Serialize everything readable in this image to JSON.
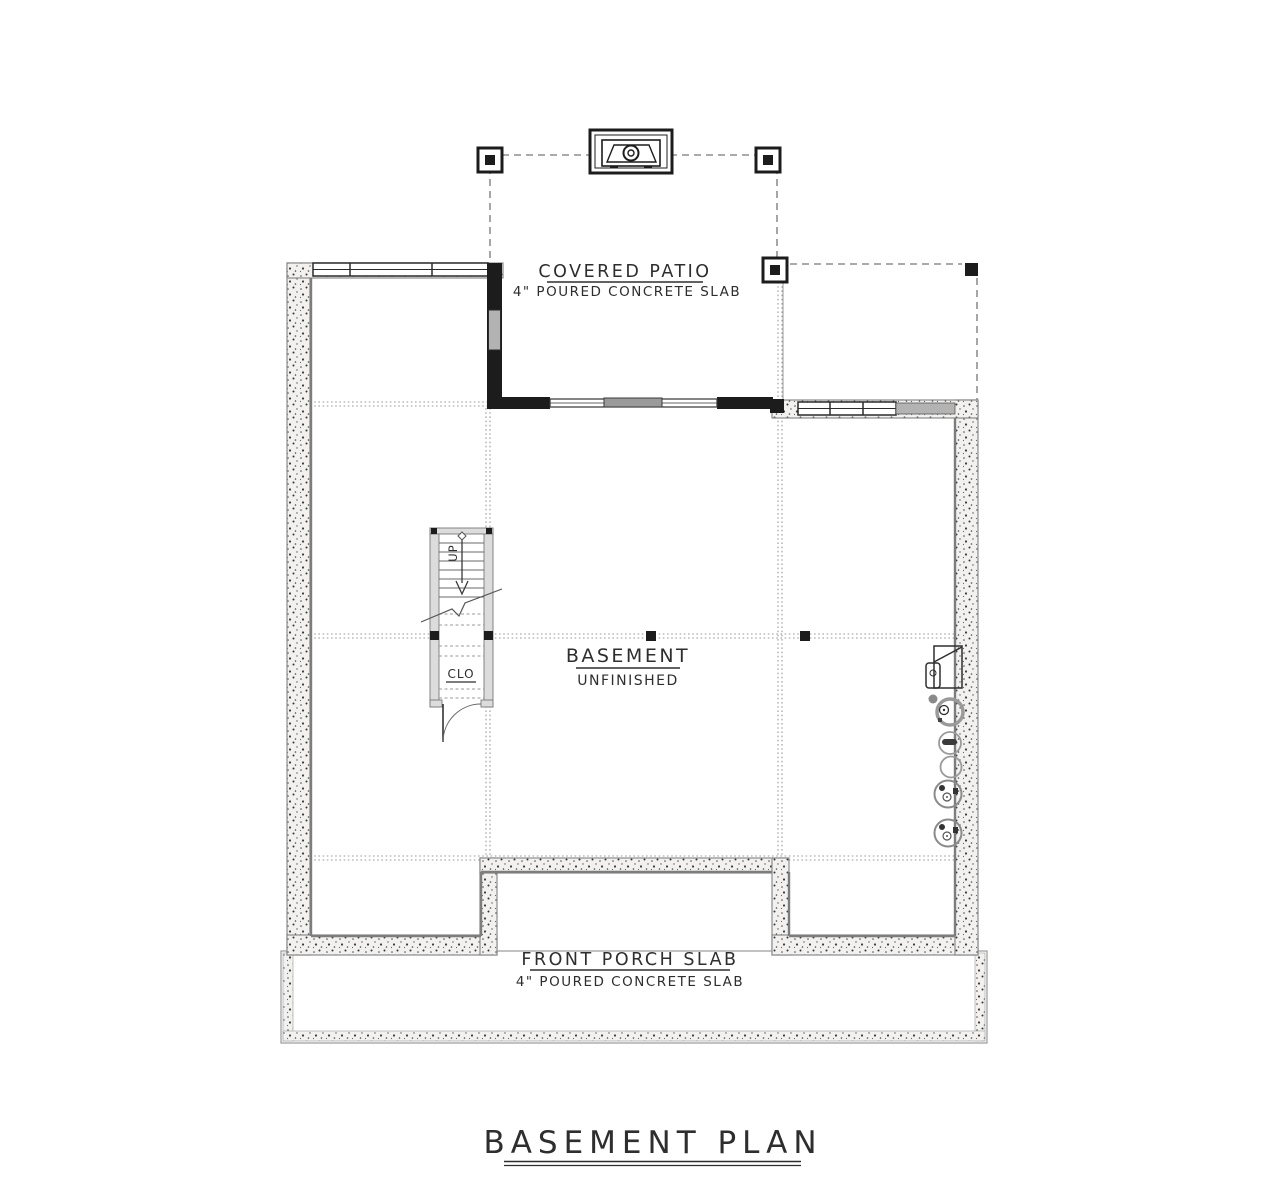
{
  "sheet": {
    "title": "BASEMENT PLAN"
  },
  "rooms": {
    "covered_patio": {
      "name": "COVERED PATIO",
      "note": "4\" POURED CONCRETE SLAB"
    },
    "basement": {
      "name": "BASEMENT",
      "note": "UNFINISHED"
    },
    "front_porch": {
      "name": "FRONT PORCH SLAB",
      "note": "4\" POURED CONCRETE SLAB"
    },
    "closet": {
      "name": "CLO"
    }
  },
  "stairs": {
    "direction_label": "UP"
  },
  "symbols": {
    "fireplace": "fireplace-icon",
    "furnace": "furnace-icon",
    "sump_pump": "sump-pump-icon",
    "floor_drain": "floor-drain-icon",
    "water_heater": "water-heater-icon",
    "support_post": "support-post-icon"
  },
  "colors": {
    "line_black": "#1c1c1c",
    "wall_gray": "#8c8c8c",
    "concrete_fill": "#f2f1ef",
    "dotted_line": "#9a9a9a",
    "text": "#2e2e2e",
    "paper": "#ffffff"
  }
}
